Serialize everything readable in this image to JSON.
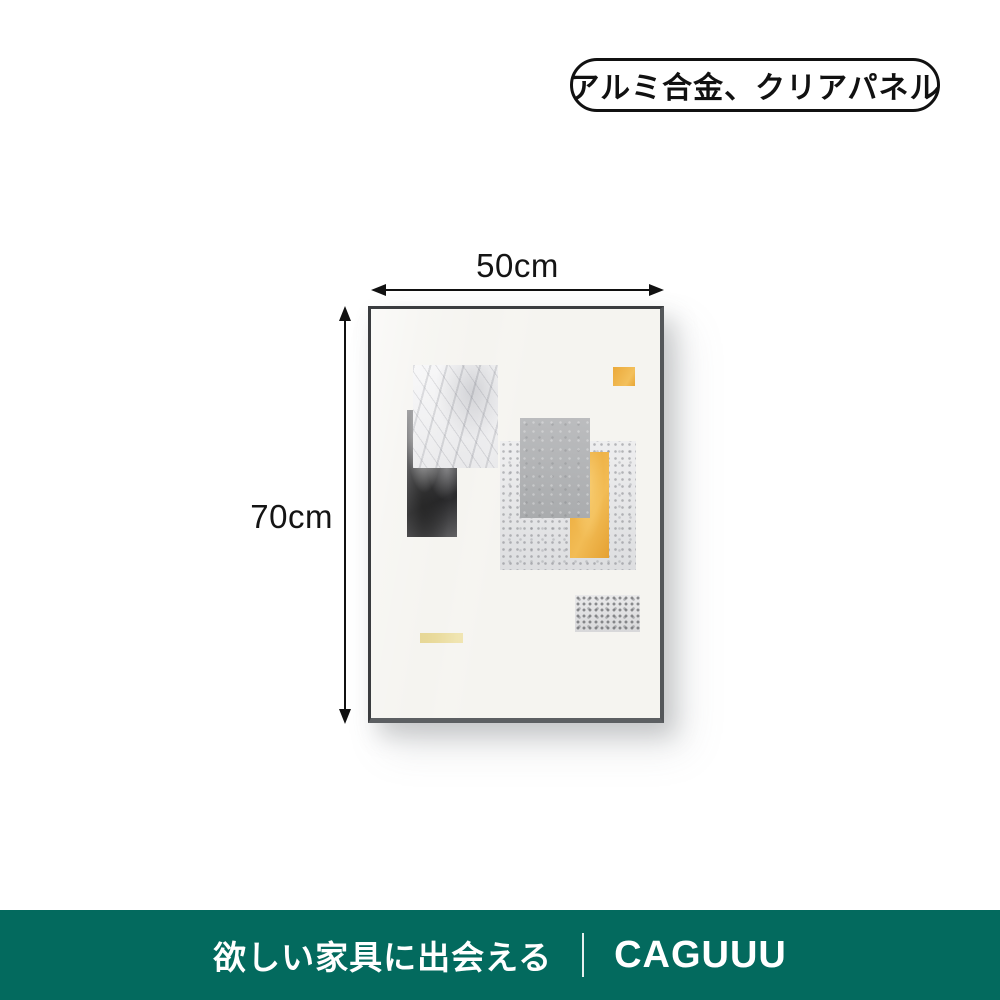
{
  "badge": {
    "label": "アルミ合金、クリアパネル"
  },
  "dimensions": {
    "width_label": "50cm",
    "height_label": "70cm"
  },
  "artwork": {
    "colors": {
      "frame": "#3A3C3F",
      "mat": "#F5F4F0",
      "gold": "#EBA93A",
      "pale_gold_strip": "#EADC9F",
      "concrete_gray": "#B3B5B7"
    }
  },
  "footer": {
    "tagline": "欲しい家具に出会える",
    "brand": "CAGUUU",
    "background": "#036A5E"
  }
}
